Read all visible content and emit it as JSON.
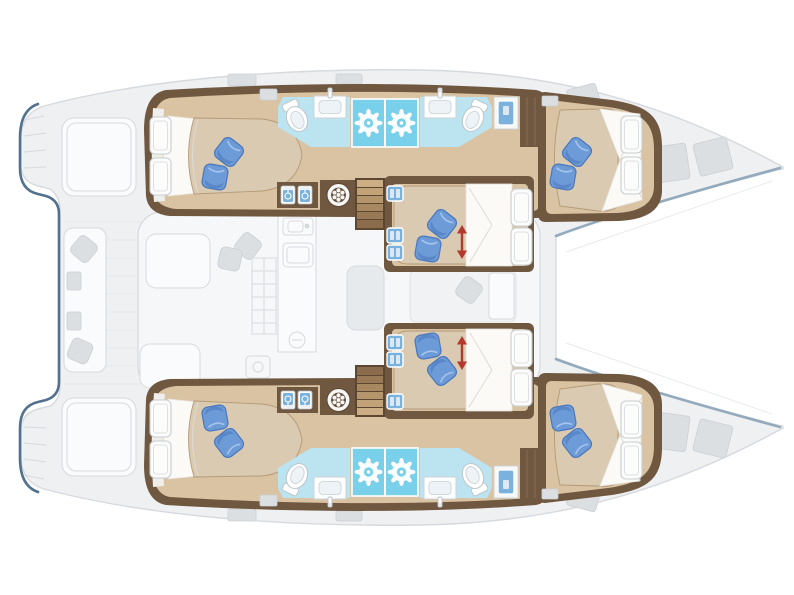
{
  "diagram": {
    "kind": "yacht-floor-plan",
    "subject": "Sailing catamaran accommodation deck plan, top-down view, bows to the right",
    "style": "cabin interiors rendered in color; exterior decks, salon, cockpit and trampoline dimmed in gray",
    "hulls": [
      {
        "id": "upper-hull",
        "rooms": [
          {
            "name": "aft-double-cabin",
            "features": [
              "double-berth",
              "two-blue-pillows",
              "two-hull-windows"
            ]
          },
          {
            "name": "aft-bathroom",
            "features": [
              "toilet",
              "washbasin-with-faucet",
              "shower-cubicle"
            ]
          },
          {
            "name": "forward-bathroom",
            "features": [
              "toilet",
              "washbasin-with-faucet",
              "shower-cubicle"
            ]
          },
          {
            "name": "forward-double-cabin",
            "features": [
              "double-berth",
              "two-blue-pillows",
              "two-hull-windows",
              "deck-hatch"
            ]
          }
        ],
        "utilities": [
          "two-washer-lockers",
          "round-washing-machine",
          "companionway-stairs",
          "three-blue-lockers",
          "wardrobe"
        ]
      },
      {
        "id": "lower-hull",
        "mirror_of": "upper-hull"
      }
    ],
    "nacelle": {
      "mid_cabins": [
        {
          "name": "upper-mid-double-cabin",
          "features": [
            "double-berth",
            "two-blue-pillows",
            "red-convertible-berth-arrow",
            "two-windows"
          ]
        },
        {
          "name": "lower-mid-double-cabin",
          "mirror_of": "upper-mid-double-cabin"
        }
      ],
      "salon_dimmed": [
        "l-sofa",
        "two-gray-cushions",
        "galley-sink",
        "stove",
        "shelf-grid",
        "counter-basin",
        "small-appliance",
        "nav-table"
      ],
      "between_mid_cabins_dimmed": [
        "spare-berth",
        "gray-cushion"
      ],
      "aft_cockpit_dimmed": [
        "bench-with-two-gray-cushions",
        "two-lounge-pads",
        "transom-steps"
      ],
      "foredeck_dimmed": [
        "trampoline",
        "four-deck-hatches",
        "two-bow-seat-pads"
      ]
    },
    "totals": {
      "cabins": 6,
      "bathrooms": 4,
      "showers": 4,
      "toilets": 4,
      "washbasins": 4,
      "convertible_berth_arrows": 2,
      "stairways": 2
    }
  },
  "colors": {
    "wood": "#6f5740",
    "wooddark": "#5d4733",
    "floor": "#d9c3a2",
    "bed": "#d9cab1",
    "bedline": "#b49a77",
    "sheet": "#fbfaf7",
    "pillow": "#6d9bd8",
    "pillowdk": "#4a77bb",
    "bath": "#bce3f0",
    "shower": "#79d0ea",
    "fixture": "#7ab2dd",
    "red": "#b5382c",
    "steel": "#93aabd",
    "steeldark": "#52718f",
    "fadefill": "#eef0f2",
    "fadeline": "#d6dade",
    "fadedetail": "#dcdfe2",
    "fadewhite": "#fafbfc"
  }
}
